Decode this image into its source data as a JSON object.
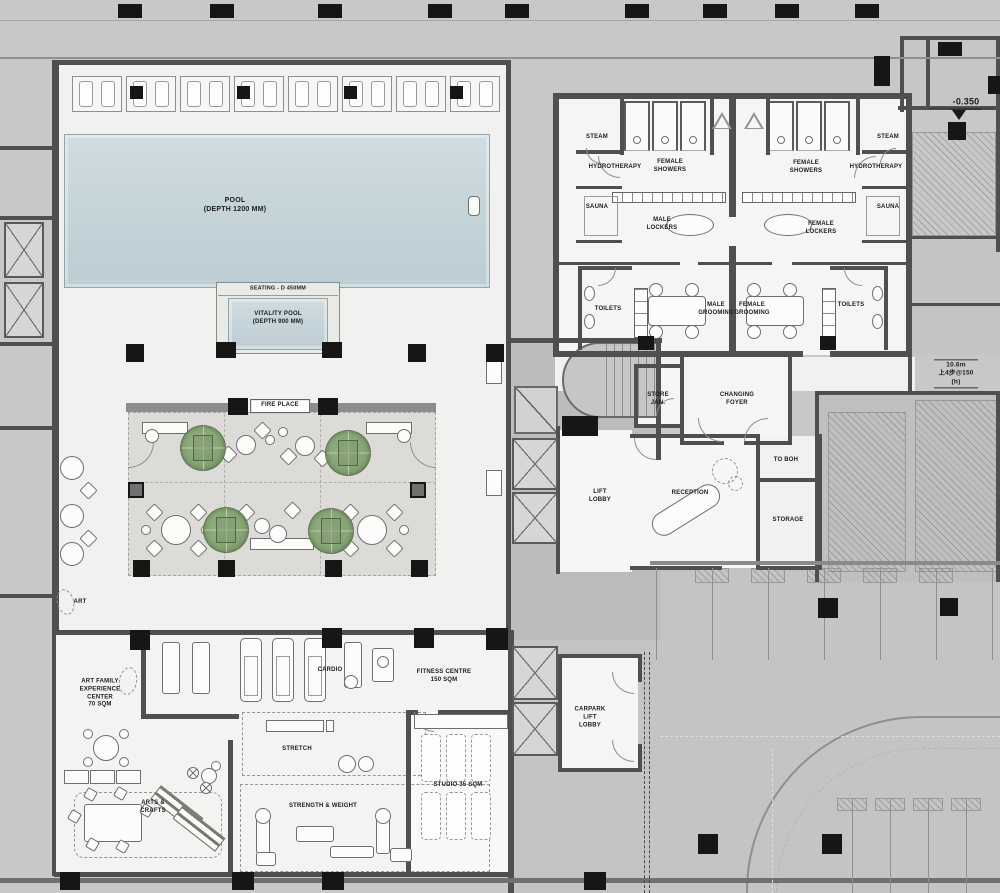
{
  "meta": {
    "drawing_type": "architectural floor plan"
  },
  "colors": {
    "background": "#c8c8c6",
    "floor": "#f2f1ef",
    "wall": "#4f4f4d",
    "pool_water": "#c6d5da",
    "lounge_floor": "#dcdbd8",
    "tree_foliage": "#7fa06c",
    "column_black": "#161614",
    "hatch_line": "#5a5a58"
  },
  "icons": {
    "tree": "canopy-tree-plan-symbol",
    "elevator": "crossed-box-lift-symbol",
    "stair": "stair-run-symbol",
    "escalator": "diagonal-ramp-symbol",
    "level_marker": "filled-triangle-datum",
    "foot_bath": "triangle-symbol",
    "door": "quarter-arc-swing"
  },
  "labels": {
    "pool": "POOL\n(DEPTH 1200 MM)",
    "seating": "SEATING - D 450MM",
    "vitality_pool": "VITALITY POOL\n(DEPTH 900 MM)",
    "fire_place": "FIRE PLACE",
    "steam_left": "STEAM",
    "steam_right": "STEAM",
    "hydrotherapy_left": "HYDROTHERAPY",
    "hydrotherapy_right": "HYDROTHERAPY",
    "sauna_left": "SAUNA",
    "sauna_right": "SAUNA",
    "female_showers_left": "FEMALE\nSHOWERS",
    "female_showers_right": "FEMALE\nSHOWERS",
    "male_lockers": "MALE\nLOCKERS",
    "female_lockers": "FEMALE\nLOCKERS",
    "toilets_left": "TOILETS",
    "toilets_right": "TOILETS",
    "male_grooming": "MALE\nGROOMING",
    "female_grooming": "FEMALE\nGROOMING",
    "store_jan": "STORE\nJAN.",
    "changing_foyer": "CHANGING\nFOYER",
    "lift_lobby": "LIFT\nLOBBY",
    "reception": "RECEPTION",
    "to_boh": "TO BOH",
    "storage": "STORAGE",
    "art": "ART",
    "art_family": "ART FAMILY\nEXPERIENCE\nCENTER\n70 SQM",
    "cardio": "CARDIO",
    "fitness_centre": "FITNESS CENTRE\n150 SQM",
    "stretch": "STRETCH",
    "strength_weight": "STRENGTH & WEIGHT",
    "studio": "STUDIO 35 SQM",
    "arts_crafts": "ARTS &\nCRAFTS",
    "carpark_lift_lobby": "CARPARK\nLIFT\nLOBBY",
    "level_marker": "-0.350",
    "stair_note": "10.6m\n上4步@150 (h)"
  }
}
